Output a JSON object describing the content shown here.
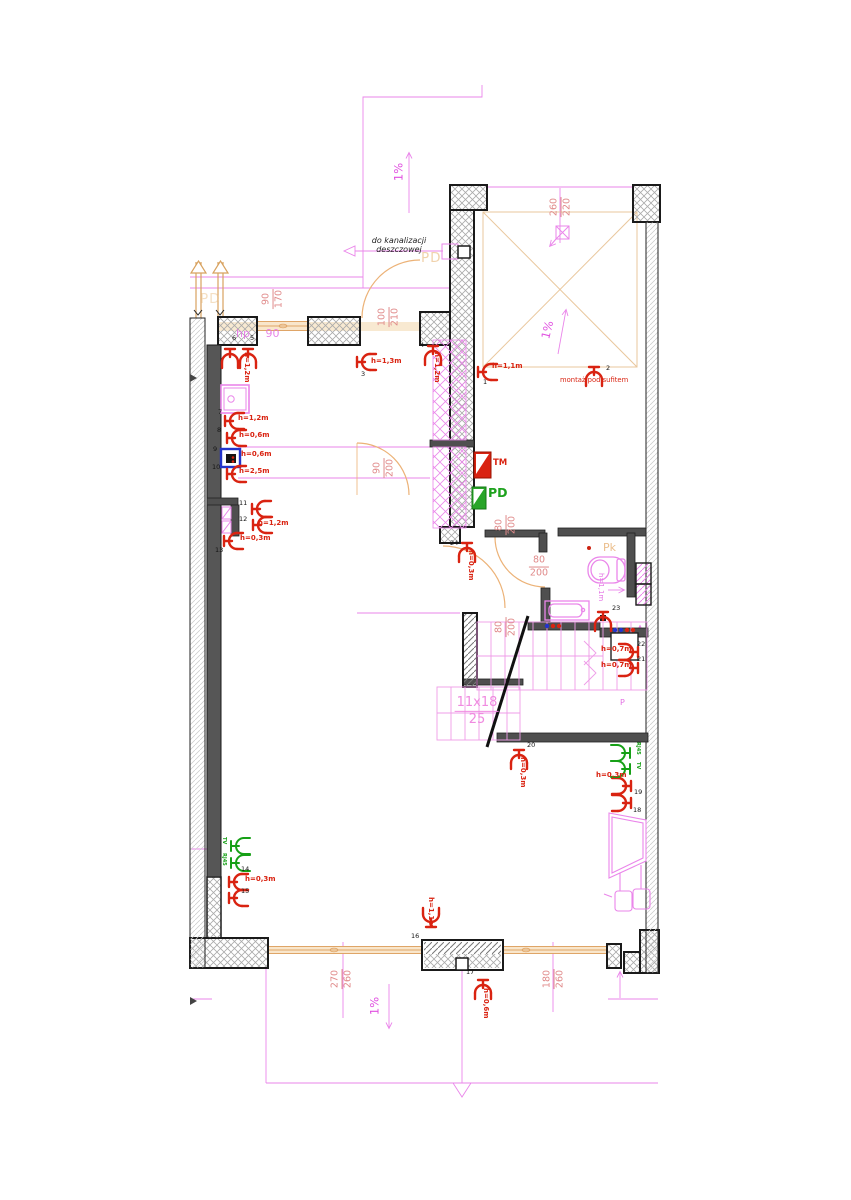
{
  "labels": {
    "drain_note1": "do kanalizacji",
    "drain_note2": "deszczowej",
    "ceiling_note": "montaż pod sufitem",
    "pd_top": "PD",
    "pd_left": "PD",
    "pk": "Pk",
    "p_room": "P",
    "hp_sill": "hp 90",
    "tm_panel": "TM",
    "pd_panel": "PD",
    "toilet_height": "h=1,1m",
    "slope1": "1%",
    "slope2": "1%",
    "slope3": "1%"
  },
  "stairs": {
    "top": "11x18",
    "bottom": "25"
  },
  "dims": [
    {
      "name": "terrace",
      "num": "260",
      "den": "220",
      "x": 561,
      "y": 207,
      "rot": true
    },
    {
      "name": "window-left",
      "num": "90",
      "den": "170",
      "x": 273,
      "y": 299,
      "rot": true
    },
    {
      "name": "entry-door",
      "num": "100",
      "den": "210",
      "x": 389,
      "y": 317,
      "rot": true
    },
    {
      "name": "corridor-door",
      "num": "90",
      "den": "200",
      "x": 384,
      "y": 468,
      "rot": true
    },
    {
      "name": "bath-door-top",
      "num": "80",
      "den": "200",
      "x": 506,
      "y": 525,
      "rot": true
    },
    {
      "name": "bath-door",
      "num": "80",
      "den": "200",
      "x": 539,
      "y": 567,
      "rot": false
    },
    {
      "name": "hall-door",
      "num": "80",
      "den": "200",
      "x": 506,
      "y": 627,
      "rot": true
    },
    {
      "name": "window-bottom-left",
      "num": "270",
      "den": "260",
      "x": 342,
      "y": 979,
      "rot": true
    },
    {
      "name": "window-bottom-right",
      "num": "180",
      "den": "260",
      "x": 554,
      "y": 979,
      "rot": true
    }
  ],
  "points": [
    {
      "n": "1",
      "x": 478,
      "y": 372,
      "dir": 0,
      "nx": 483,
      "ny": 379,
      "h": "h=1,1m",
      "hx": 492,
      "hy": 363,
      "hrot": false
    },
    {
      "n": "2",
      "x": 594,
      "y": 367,
      "dir": 90,
      "nx": 606,
      "ny": 365,
      "h": null
    },
    {
      "n": "3",
      "x": 357,
      "y": 362,
      "dir": 0,
      "nx": 361,
      "ny": 371,
      "h": "h=1,3m",
      "hx": 371,
      "hy": 358,
      "hrot": false
    },
    {
      "n": "4",
      "x": 433,
      "y": 346,
      "dir": 90,
      "nx": 420,
      "ny": 342,
      "h": "h=1,2m",
      "hx": 440,
      "hy": 352,
      "hrot": true
    },
    {
      "n": "5",
      "x": 248,
      "y": 349,
      "dir": 90,
      "nx": 250,
      "ny": 335,
      "h": null
    },
    {
      "n": "6",
      "x": 230,
      "y": 349,
      "dir": 90,
      "nx": 232,
      "ny": 335,
      "h": "h=1,2m",
      "hx": 250,
      "hy": 352,
      "hrot": true
    },
    {
      "n": "7",
      "x": 225,
      "y": 421,
      "dir": 0,
      "nx": 218,
      "ny": 409,
      "h": "h=1,2m",
      "hx": 238,
      "hy": 415,
      "hrot": false
    },
    {
      "n": "8",
      "x": 227,
      "y": 438,
      "dir": 0,
      "nx": 217,
      "ny": 427,
      "h": "h=0,6m",
      "hx": 239,
      "hy": 432,
      "hrot": false
    },
    {
      "n": "9",
      "x": 221,
      "y": 449,
      "dir": null,
      "nx": 213,
      "ny": 446,
      "h": "h=0,6m",
      "hx": 241,
      "hy": 451,
      "hrot": false
    },
    {
      "n": "10",
      "x": 227,
      "y": 474,
      "dir": 0,
      "nx": 212,
      "ny": 464,
      "h": "h=2,5m",
      "hx": 239,
      "hy": 468,
      "hrot": false
    },
    {
      "n": "11",
      "x": 252,
      "y": 509,
      "dir": 0,
      "nx": 239,
      "ny": 500,
      "h": null
    },
    {
      "n": "12",
      "x": 253,
      "y": 525,
      "dir": 0,
      "nx": 239,
      "ny": 516,
      "h": "h=1,2m",
      "hx": 258,
      "hy": 520,
      "hrot": false
    },
    {
      "n": "13",
      "x": 224,
      "y": 541,
      "dir": 0,
      "nx": 215,
      "ny": 547,
      "h": "h=0,3m",
      "hx": 240,
      "hy": 535,
      "hrot": false
    },
    {
      "n": "14",
      "x": 229,
      "y": 882,
      "dir": 0,
      "nx": 241,
      "ny": 866,
      "h": "h=0,3m",
      "hx": 245,
      "hy": 876,
      "hrot": false
    },
    {
      "n": "15",
      "x": 229,
      "y": 898,
      "dir": 0,
      "nx": 241,
      "ny": 888,
      "h": null
    },
    {
      "n": "16",
      "x": 431,
      "y": 927,
      "dir": 270,
      "nx": 411,
      "ny": 933,
      "h": "h=1,1m",
      "hx": 434,
      "hy": 897,
      "hrot": true
    },
    {
      "n": "17",
      "x": 483,
      "y": 980,
      "dir": 90,
      "nx": 466,
      "ny": 969,
      "h": "h=0,6m",
      "hx": 489,
      "hy": 988,
      "hrot": true
    },
    {
      "n": "18",
      "x": 631,
      "y": 803,
      "dir": 180,
      "nx": 633,
      "ny": 807,
      "h": null
    },
    {
      "n": "19",
      "x": 631,
      "y": 786,
      "dir": 180,
      "nx": 634,
      "ny": 789,
      "h": "h=0,3m",
      "hx": 596,
      "hy": 772,
      "hrot": false
    },
    {
      "n": "20",
      "x": 519,
      "y": 750,
      "dir": 90,
      "nx": 527,
      "ny": 742,
      "h": "h=0,3m",
      "hx": 526,
      "hy": 757,
      "hrot": true
    },
    {
      "n": "21",
      "x": 638,
      "y": 668,
      "dir": 180,
      "nx": 637,
      "ny": 656,
      "h": "h=0,7m",
      "hx": 601,
      "hy": 662,
      "hrot": false
    },
    {
      "n": "22",
      "x": 638,
      "y": 652,
      "dir": 180,
      "nx": 637,
      "ny": 641,
      "h": "h=0,7m",
      "hx": 601,
      "hy": 646,
      "hrot": false
    },
    {
      "n": "23",
      "x": 603,
      "y": 612,
      "dir": 90,
      "nx": 612,
      "ny": 605,
      "h": null
    },
    {
      "n": "24",
      "x": 467,
      "y": 543,
      "dir": 90,
      "nx": 450,
      "ny": 540,
      "h": "h=0,3m",
      "hx": 474,
      "hy": 550,
      "hrot": true
    }
  ],
  "green_points": [
    {
      "label": "TV",
      "x": 231,
      "y": 846,
      "dir": 0,
      "lx": 226,
      "ly": 837
    },
    {
      "label": "RJ45",
      "x": 231,
      "y": 863,
      "dir": 0,
      "lx": 226,
      "ly": 853
    },
    {
      "label": "RJ45",
      "x": 630,
      "y": 753,
      "dir": 180,
      "lx": 640,
      "ly": 742
    },
    {
      "label": "TV",
      "x": 630,
      "y": 769,
      "dir": 180,
      "lx": 640,
      "ly": 762
    }
  ],
  "sockets": [
    {
      "x": 547,
      "y": 626,
      "colors": [
        "#2233cc",
        "#d92311",
        "#d92311"
      ]
    },
    {
      "x": 615,
      "y": 630,
      "colors": [
        "#2233cc",
        "#2233cc",
        "#d92311",
        "#d92311"
      ]
    }
  ],
  "colors": {
    "red": "#d92311",
    "green": "#17a017",
    "blue": "#2233cc",
    "magenta": "#ea86ea",
    "dim_text": "#e08a8a",
    "orange": "#ecb277"
  }
}
